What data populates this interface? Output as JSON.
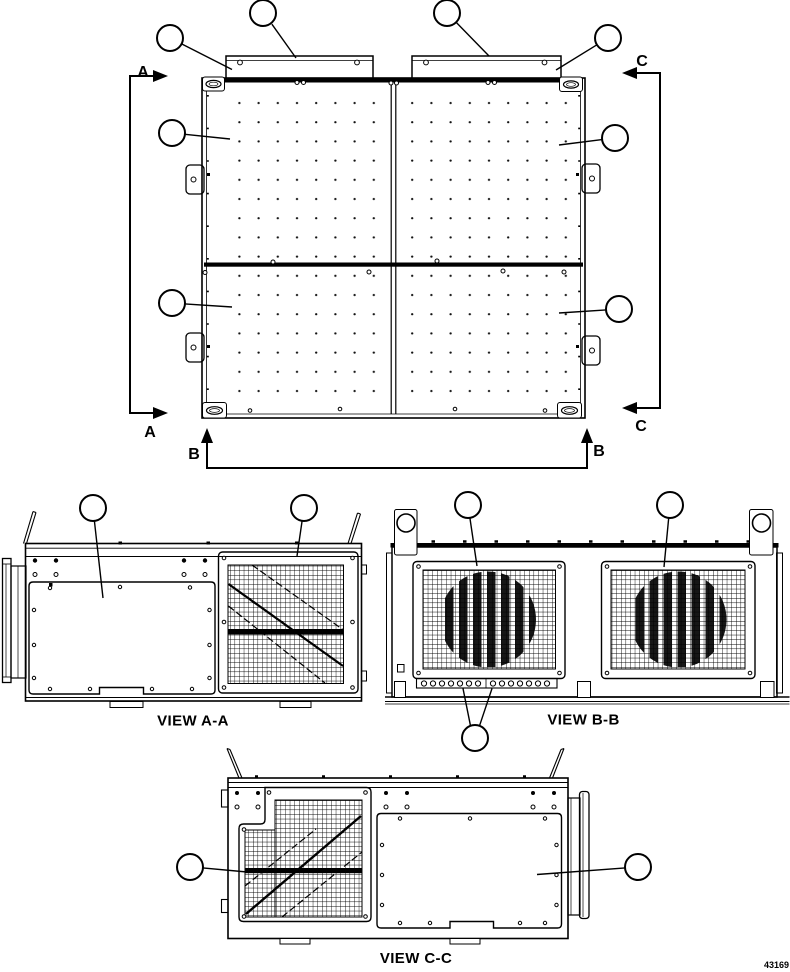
{
  "figure": {
    "number": "43169",
    "background_color": "#ffffff",
    "line_color": "#000000",
    "callout_text": ""
  },
  "top_view": {
    "section_labels": {
      "a_top": "A",
      "a_bottom": "A",
      "b_left": "B",
      "b_right": "B",
      "c_top": "C",
      "c_bottom": "C"
    },
    "callout_count": 8
  },
  "view_aa": {
    "label": "VIEW A-A",
    "callout_count": 2
  },
  "view_bb": {
    "label": "VIEW B-B",
    "callout_count": 3
  },
  "view_cc": {
    "label": "VIEW C-C",
    "callout_count": 2
  }
}
